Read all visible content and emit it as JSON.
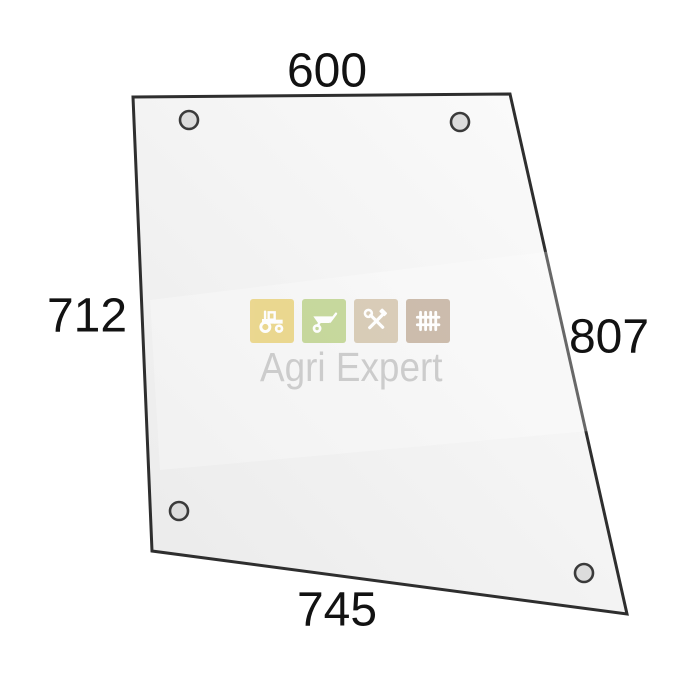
{
  "diagram": {
    "description": "trapezoidal glass panel with four mounting holes",
    "dimensions": {
      "top": "600",
      "left": "712",
      "right": "807",
      "bottom": "745"
    },
    "outline_color": "#2e2e2e",
    "glass_fill_light": "#fbfbfb",
    "glass_fill_dark": "#ebebeb",
    "hole_fill": "#dcdcdc",
    "hole_ring": "#3a3a3a"
  },
  "watermark": {
    "text": "Agri Expert",
    "text_color": "#c9c9c9",
    "icons": [
      {
        "name": "tractor-icon",
        "color": "#e7cf74"
      },
      {
        "name": "wheelbarrow-icon",
        "color": "#b9cf84"
      },
      {
        "name": "tools-icon",
        "color": "#d0c0a6"
      },
      {
        "name": "fence-icon",
        "color": "#c0ac98"
      }
    ]
  }
}
